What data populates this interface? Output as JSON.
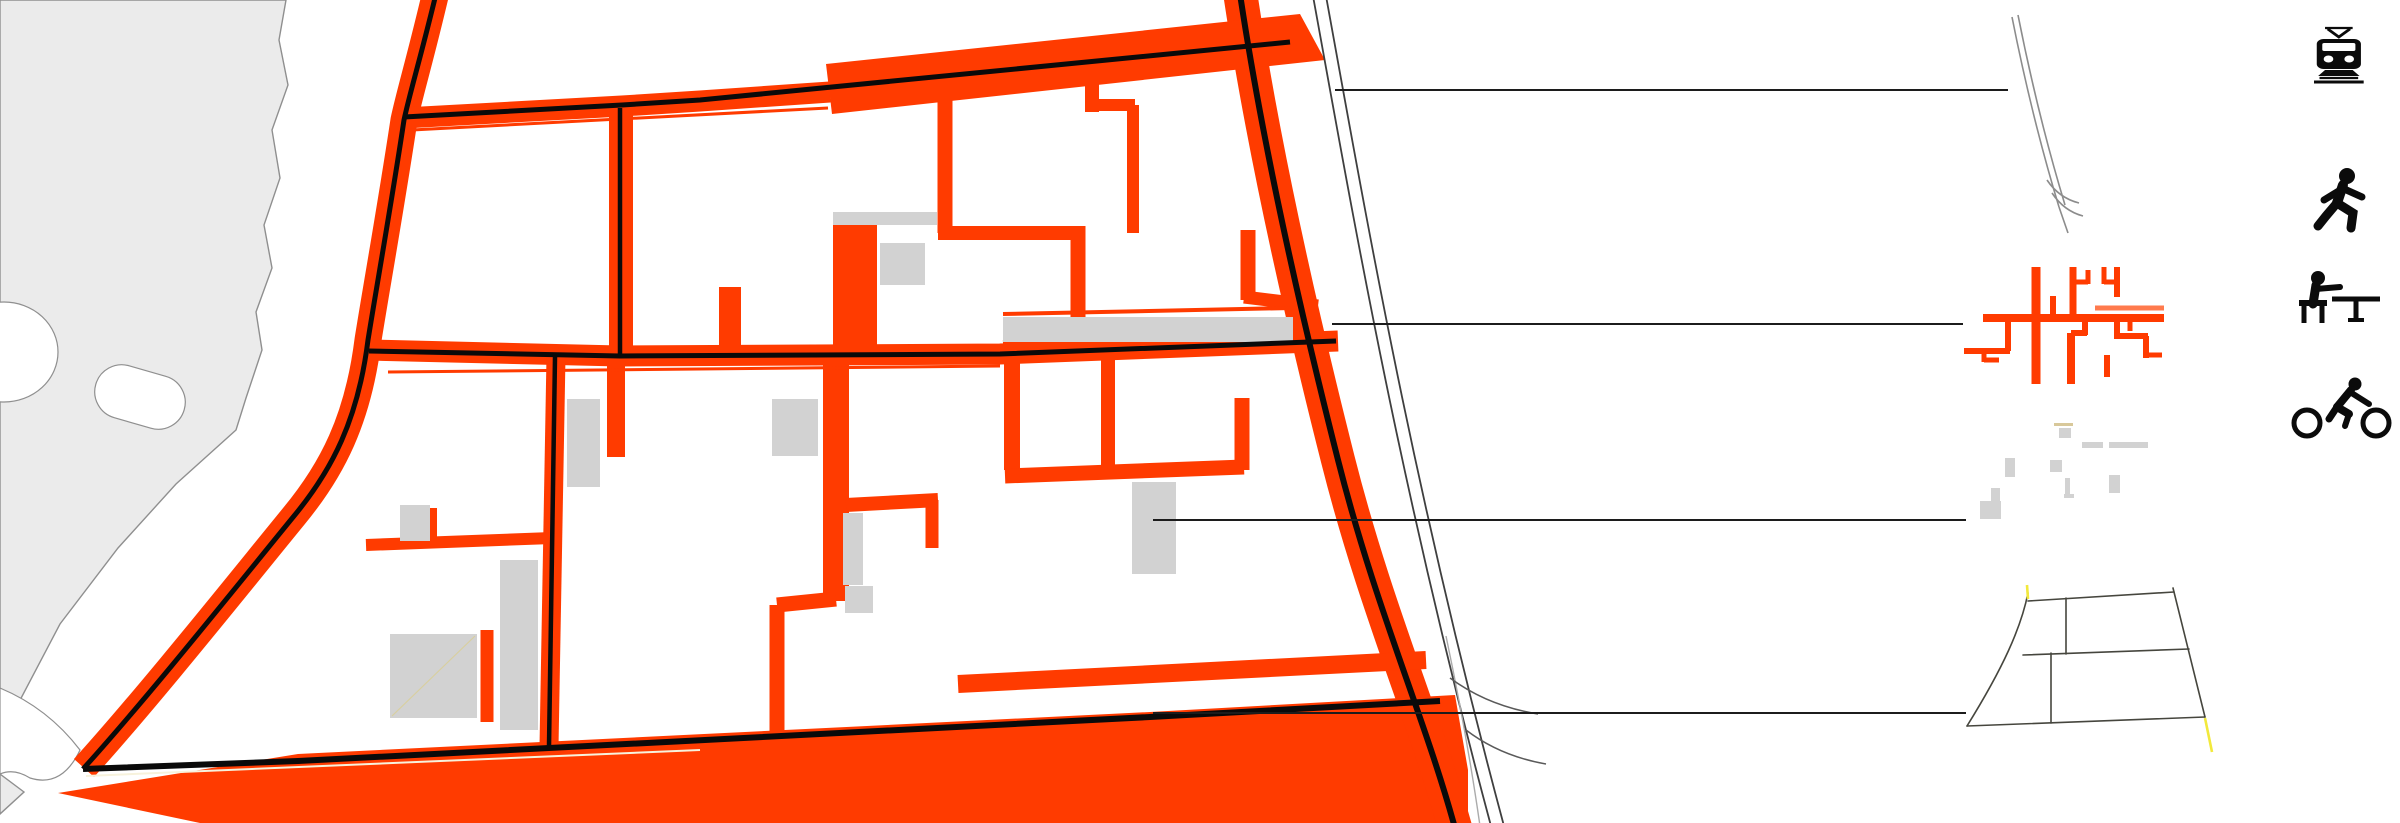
{
  "figure": {
    "kind": "urban-design figure-ground map with transport layer legend",
    "background": "#ffffff",
    "text_content": "none — purely graphic plan drawing"
  },
  "palette": {
    "street_orange": "#ff3b00",
    "block_gray": "#d2d2d2",
    "land_gray": "#ebebeb",
    "land_outline": "#8f8f8f",
    "centerline_black": "#0a0a0a",
    "callout_black": "#1c1c1c",
    "track_gray": "#8c8c8c",
    "accent_yellow": "#f2e93c",
    "cream": "#f7f2dc",
    "icon_black": "#0b0b0b"
  },
  "legend": {
    "rows": [
      {
        "id": "tram",
        "icon": "tram-icon",
        "diagram": "tram-tracks-diagram",
        "callout": {
          "x1": 1335,
          "y1": 90,
          "x2": 2008,
          "y2": 90
        }
      },
      {
        "id": "pedestrian",
        "icon": "pedestrian-icon",
        "diagram": "pedestrian-network-diagram",
        "callout": {
          "x1": 1332,
          "y1": 324,
          "x2": 1963,
          "y2": 324
        }
      },
      {
        "id": "street-furniture",
        "icon": "seated-person-icon",
        "diagram": "furniture-plazas-diagram",
        "callout": {
          "x1": 1153,
          "y1": 520,
          "x2": 1966,
          "y2": 520
        }
      },
      {
        "id": "cycling",
        "icon": "cyclist-icon",
        "diagram": "cycle-outline-diagram",
        "callout": {
          "x1": 1153,
          "y1": 713,
          "x2": 1966,
          "y2": 713
        }
      }
    ]
  }
}
